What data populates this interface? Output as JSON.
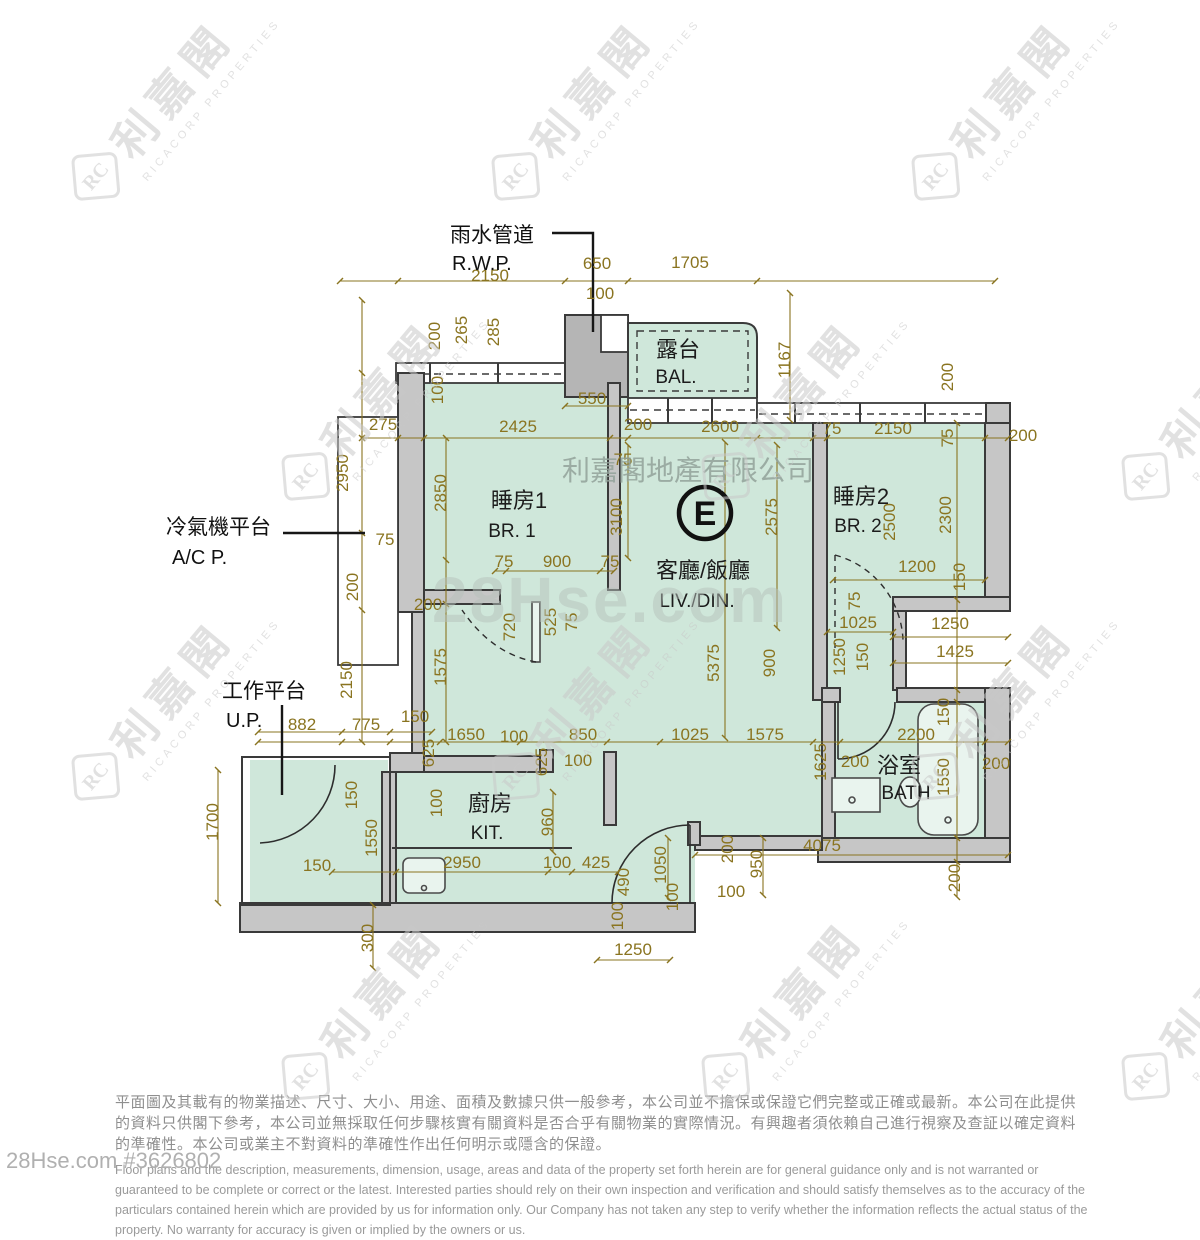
{
  "branding": {
    "watermark_logo_mark": "RC",
    "watermark_logo_zh": "利嘉閣",
    "watermark_logo_en": "RICACORP PROPERTIES",
    "center_watermark_company": "利嘉閣地產有限公司",
    "center_watermark_site": "28Hse.com",
    "listing_ref": "28Hse.com #3626802"
  },
  "colors": {
    "dimension": "#8a7420",
    "room_fill": "#cfe7da",
    "wall_fill": "#c6c6c6",
    "wall_line": "#3a3a3a",
    "watermark": "#c9c9c9",
    "footer_text": "#8f8f8f"
  },
  "floorplan": {
    "unit_label": "E",
    "rooms": [
      {
        "id": "br1",
        "zh": "睡房1",
        "en": "BR. 1",
        "x": 519,
        "y": 508,
        "ex": 512,
        "ey": 537
      },
      {
        "id": "livdin",
        "zh": "客廳/飯廳",
        "en": "LIV./DIN.",
        "x": 703,
        "y": 578,
        "ex": 697,
        "ey": 607
      },
      {
        "id": "br2",
        "zh": "睡房2",
        "en": "BR. 2",
        "x": 861,
        "y": 504,
        "ex": 858,
        "ey": 532
      },
      {
        "id": "balcony",
        "zh": "露台",
        "en": "BAL.",
        "x": 678,
        "y": 357,
        "ex": 676,
        "ey": 383
      },
      {
        "id": "kitchen",
        "zh": "廚房",
        "en": "KIT.",
        "x": 490,
        "y": 811,
        "ex": 487,
        "ey": 839
      },
      {
        "id": "bath",
        "zh": "浴室",
        "en": "BATH",
        "x": 899,
        "y": 773,
        "ex": 906,
        "ey": 799
      }
    ],
    "annotations": [
      {
        "id": "rwp",
        "zh": "雨水管道",
        "en": "R.W.P.",
        "x": 450,
        "y": 242,
        "ex": 452,
        "ey": 270
      },
      {
        "id": "acp",
        "zh": "冷氣機平台",
        "en": "A/C P.",
        "x": 166,
        "y": 534,
        "ex": 172,
        "ey": 564
      },
      {
        "id": "up",
        "zh": "工作平台",
        "en": "U.P.",
        "x": 222,
        "y": 698,
        "ex": 226,
        "ey": 727
      }
    ],
    "dimensions": [
      [
        "2150",
        490,
        281,
        0
      ],
      [
        "650",
        597,
        269,
        0
      ],
      [
        "1705",
        690,
        268,
        0
      ],
      [
        "100",
        600,
        299,
        0
      ],
      [
        "265",
        467,
        330,
        1
      ],
      [
        "285",
        499,
        332,
        1
      ],
      [
        "200",
        440,
        336,
        1
      ],
      [
        "100",
        443,
        390,
        1
      ],
      [
        "550",
        592,
        404,
        0
      ],
      [
        "1167",
        790,
        360,
        1
      ],
      [
        "200",
        953,
        377,
        1
      ],
      [
        "200",
        1023,
        441,
        0
      ],
      [
        "275",
        383,
        430,
        0
      ],
      [
        "2425",
        518,
        432,
        0
      ],
      [
        "200",
        638,
        430,
        0
      ],
      [
        "2600",
        720,
        432,
        0
      ],
      [
        "75",
        832,
        434,
        0
      ],
      [
        "2150",
        893,
        434,
        0
      ],
      [
        "75",
        953,
        438,
        1
      ],
      [
        "2950",
        348,
        473,
        1
      ],
      [
        "2850",
        446,
        493,
        1
      ],
      [
        "75",
        623,
        465,
        0
      ],
      [
        "3100",
        622,
        517,
        1
      ],
      [
        "2575",
        777,
        517,
        1
      ],
      [
        "2500",
        895,
        522,
        1
      ],
      [
        "2300",
        951,
        515,
        1
      ],
      [
        "75",
        385,
        545,
        0
      ],
      [
        "200",
        358,
        587,
        1
      ],
      [
        "200",
        428,
        610,
        0
      ],
      [
        "75",
        504,
        567,
        0
      ],
      [
        "900",
        557,
        567,
        0
      ],
      [
        "75",
        610,
        567,
        0
      ],
      [
        "1200",
        917,
        572,
        0
      ],
      [
        "150",
        965,
        577,
        1
      ],
      [
        "720",
        515,
        627,
        1
      ],
      [
        "525",
        556,
        622,
        1
      ],
      [
        "75",
        577,
        622,
        1
      ],
      [
        "1575",
        446,
        667,
        1
      ],
      [
        "5375",
        719,
        663,
        1
      ],
      [
        "900",
        775,
        663,
        1
      ],
      [
        "75",
        860,
        601,
        1
      ],
      [
        "1025",
        858,
        628,
        0
      ],
      [
        "1250",
        845,
        657,
        1
      ],
      [
        "150",
        868,
        657,
        1
      ],
      [
        "1250",
        950,
        629,
        0
      ],
      [
        "1425",
        955,
        657,
        0
      ],
      [
        "2150",
        352,
        680,
        1
      ],
      [
        "882",
        302,
        730,
        0
      ],
      [
        "775",
        366,
        730,
        0
      ],
      [
        "150",
        415,
        722,
        0
      ],
      [
        "625",
        434,
        753,
        1
      ],
      [
        "1650",
        466,
        740,
        0
      ],
      [
        "100",
        514,
        742,
        0
      ],
      [
        "625",
        547,
        762,
        1
      ],
      [
        "850",
        583,
        740,
        0
      ],
      [
        "100",
        578,
        766,
        0
      ],
      [
        "1025",
        690,
        740,
        0
      ],
      [
        "1575",
        765,
        740,
        0
      ],
      [
        "1625",
        826,
        762,
        1
      ],
      [
        "2200",
        916,
        740,
        0
      ],
      [
        "200",
        855,
        767,
        0
      ],
      [
        "1550",
        949,
        777,
        1
      ],
      [
        "150",
        949,
        712,
        1
      ],
      [
        "200",
        996,
        769,
        0
      ],
      [
        "1700",
        218,
        822,
        1
      ],
      [
        "150",
        357,
        795,
        1
      ],
      [
        "1550",
        377,
        838,
        1
      ],
      [
        "100",
        442,
        803,
        1
      ],
      [
        "960",
        553,
        822,
        1
      ],
      [
        "150",
        317,
        871,
        0
      ],
      [
        "2950",
        462,
        868,
        0
      ],
      [
        "100",
        557,
        868,
        0
      ],
      [
        "425",
        596,
        868,
        0
      ],
      [
        "490",
        629,
        882,
        1
      ],
      [
        "1050",
        666,
        865,
        1
      ],
      [
        "100",
        678,
        897,
        1
      ],
      [
        "100",
        623,
        916,
        1
      ],
      [
        "200",
        733,
        849,
        1
      ],
      [
        "950",
        762,
        864,
        1
      ],
      [
        "100",
        731,
        897,
        0
      ],
      [
        "4075",
        822,
        851,
        0
      ],
      [
        "200",
        960,
        878,
        1
      ],
      [
        "300",
        373,
        938,
        1
      ],
      [
        "1250",
        633,
        955,
        0
      ]
    ]
  },
  "footer": {
    "disclaimer_zh": "平面圖及其載有的物業描述、尺寸、大小、用途、面積及數據只供一般參考，本公司並不擔保或保證它們完整或正確或最新。本公司在此提供的資料只供閣下參考，本公司並無採取任何步驟核實有關資料是否合乎有關物業的實際情況。有興趣者須依賴自己進行視察及查証以確定資料的準確性。本公司或業主不對資料的準確性作出任何明示或隱含的保證。",
    "disclaimer_en": "Floor plans and the description, measurements, dimension, usage, areas and data of the property set forth herein are for general guidance only and is not warranted or guaranteed to be complete or correct or the latest.  Interested parties should rely on their own inspection and verification and should satisfy themselves as to the accuracy of the particulars contained herein which are provided by us for information only.  Our Company has not taken any step to verify whether the information reflects the actual status of the property.  No warranty for accuracy is given or implied by the owners or us."
  }
}
